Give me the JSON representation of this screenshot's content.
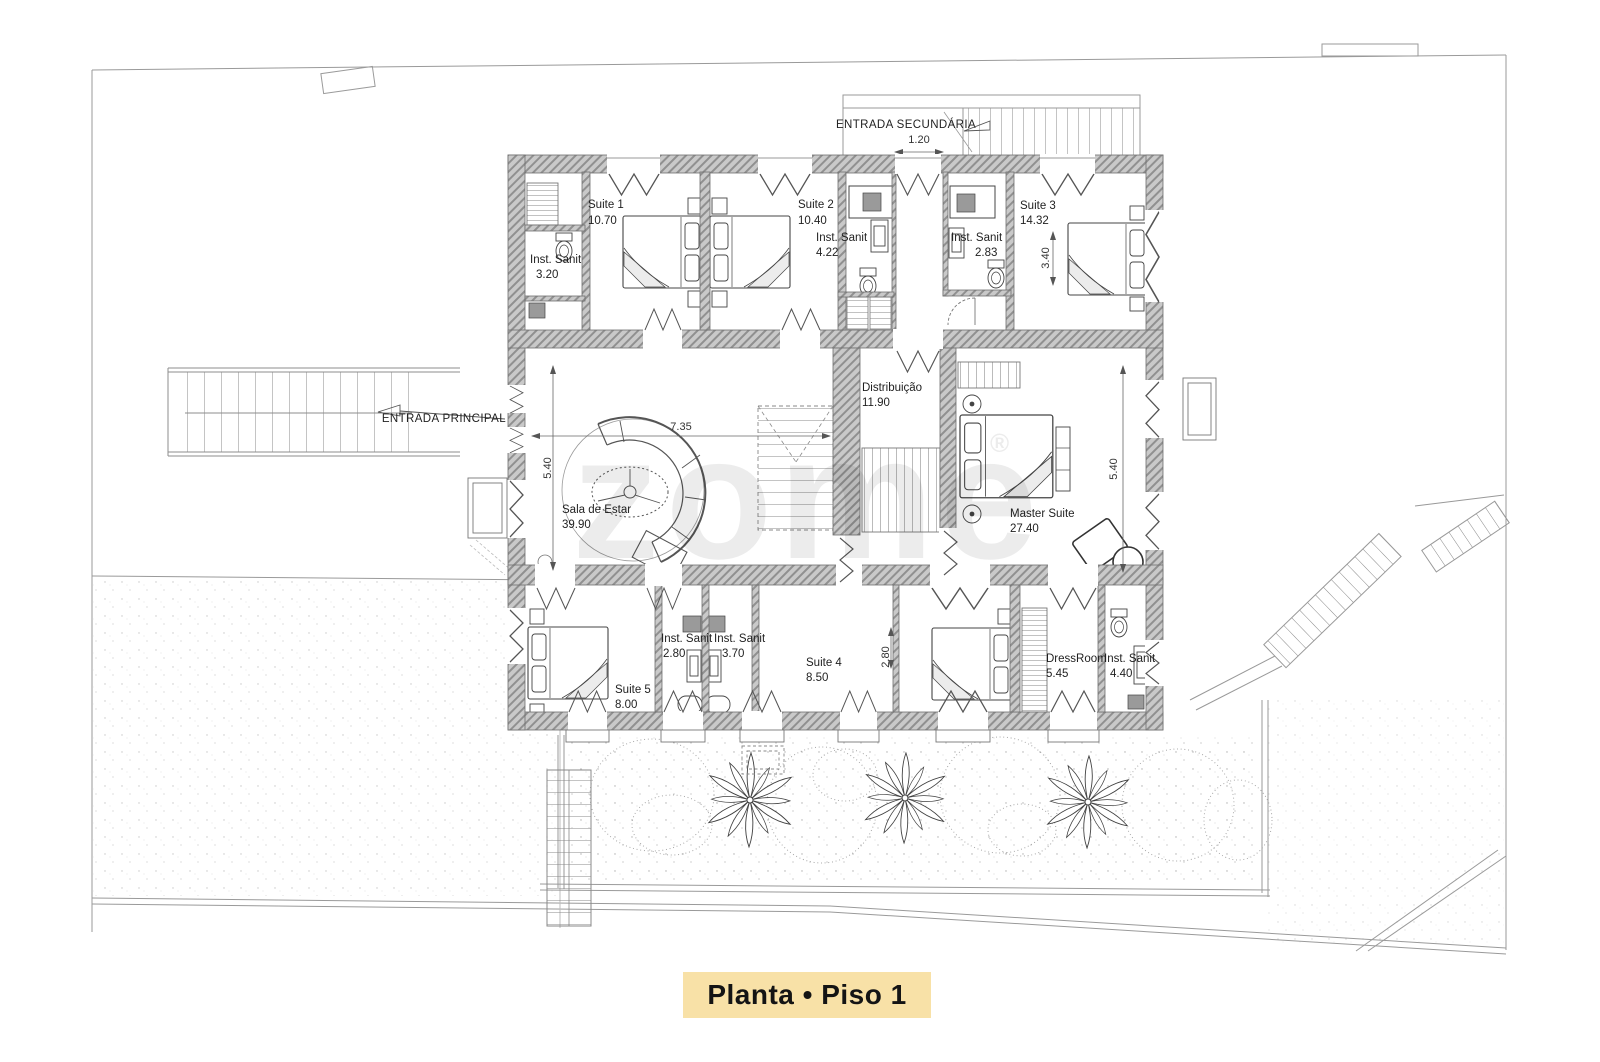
{
  "page": {
    "title_badge": "Planta • Piso 1",
    "watermark": "zome",
    "watermark_reg": "®",
    "colors": {
      "badge_bg": "#F8E1A7",
      "badge_text": "#141414",
      "wall_fill": "#c9c9c9",
      "wall_hatch": "#909090",
      "plan_line": "#4a4a4a",
      "site_line": "#9a9a9a"
    }
  },
  "entrances": {
    "principal_label": "ENTRADA PRINCIPAL",
    "secundaria_label": "ENTRADA SECUNDÁRIA"
  },
  "rooms": {
    "suite1": {
      "name": "Suite 1",
      "area": "10.70"
    },
    "sanit1": {
      "name": "Inst. Sanit",
      "area": "3.20"
    },
    "suite2": {
      "name": "Suite 2",
      "area": "10.40"
    },
    "sanit2": {
      "name": "Inst. Sanit",
      "area": "4.22"
    },
    "sanit3": {
      "name": "Inst. Sanit",
      "area": "2.83"
    },
    "suite3": {
      "name": "Suite 3",
      "area": "14.32"
    },
    "sala": {
      "name": "Sala de Estar",
      "area": "39.90"
    },
    "distribuicao": {
      "name": "Distribuição",
      "area": "11.90"
    },
    "master": {
      "name": "Master Suite",
      "area": "27.40"
    },
    "suite5": {
      "name": "Suite 5",
      "area": "8.00"
    },
    "sanit5": {
      "name": "Inst. Sanit",
      "area": "2.80"
    },
    "sanit4": {
      "name": "Inst. Sanit",
      "area": "3.70"
    },
    "suite4": {
      "name": "Suite 4",
      "area": "8.50"
    },
    "dressroom": {
      "name": "DressRoom",
      "area": "5.45"
    },
    "sanit_master": {
      "name": "Inst. Sanit",
      "area": "4.40"
    }
  },
  "dimensions": {
    "sala_width": "7.35",
    "sala_height": "5.40",
    "master_height": "5.40",
    "suite3_width": "3.40",
    "suite4_depth": "2.80",
    "secondary_entrance": "1.20"
  }
}
